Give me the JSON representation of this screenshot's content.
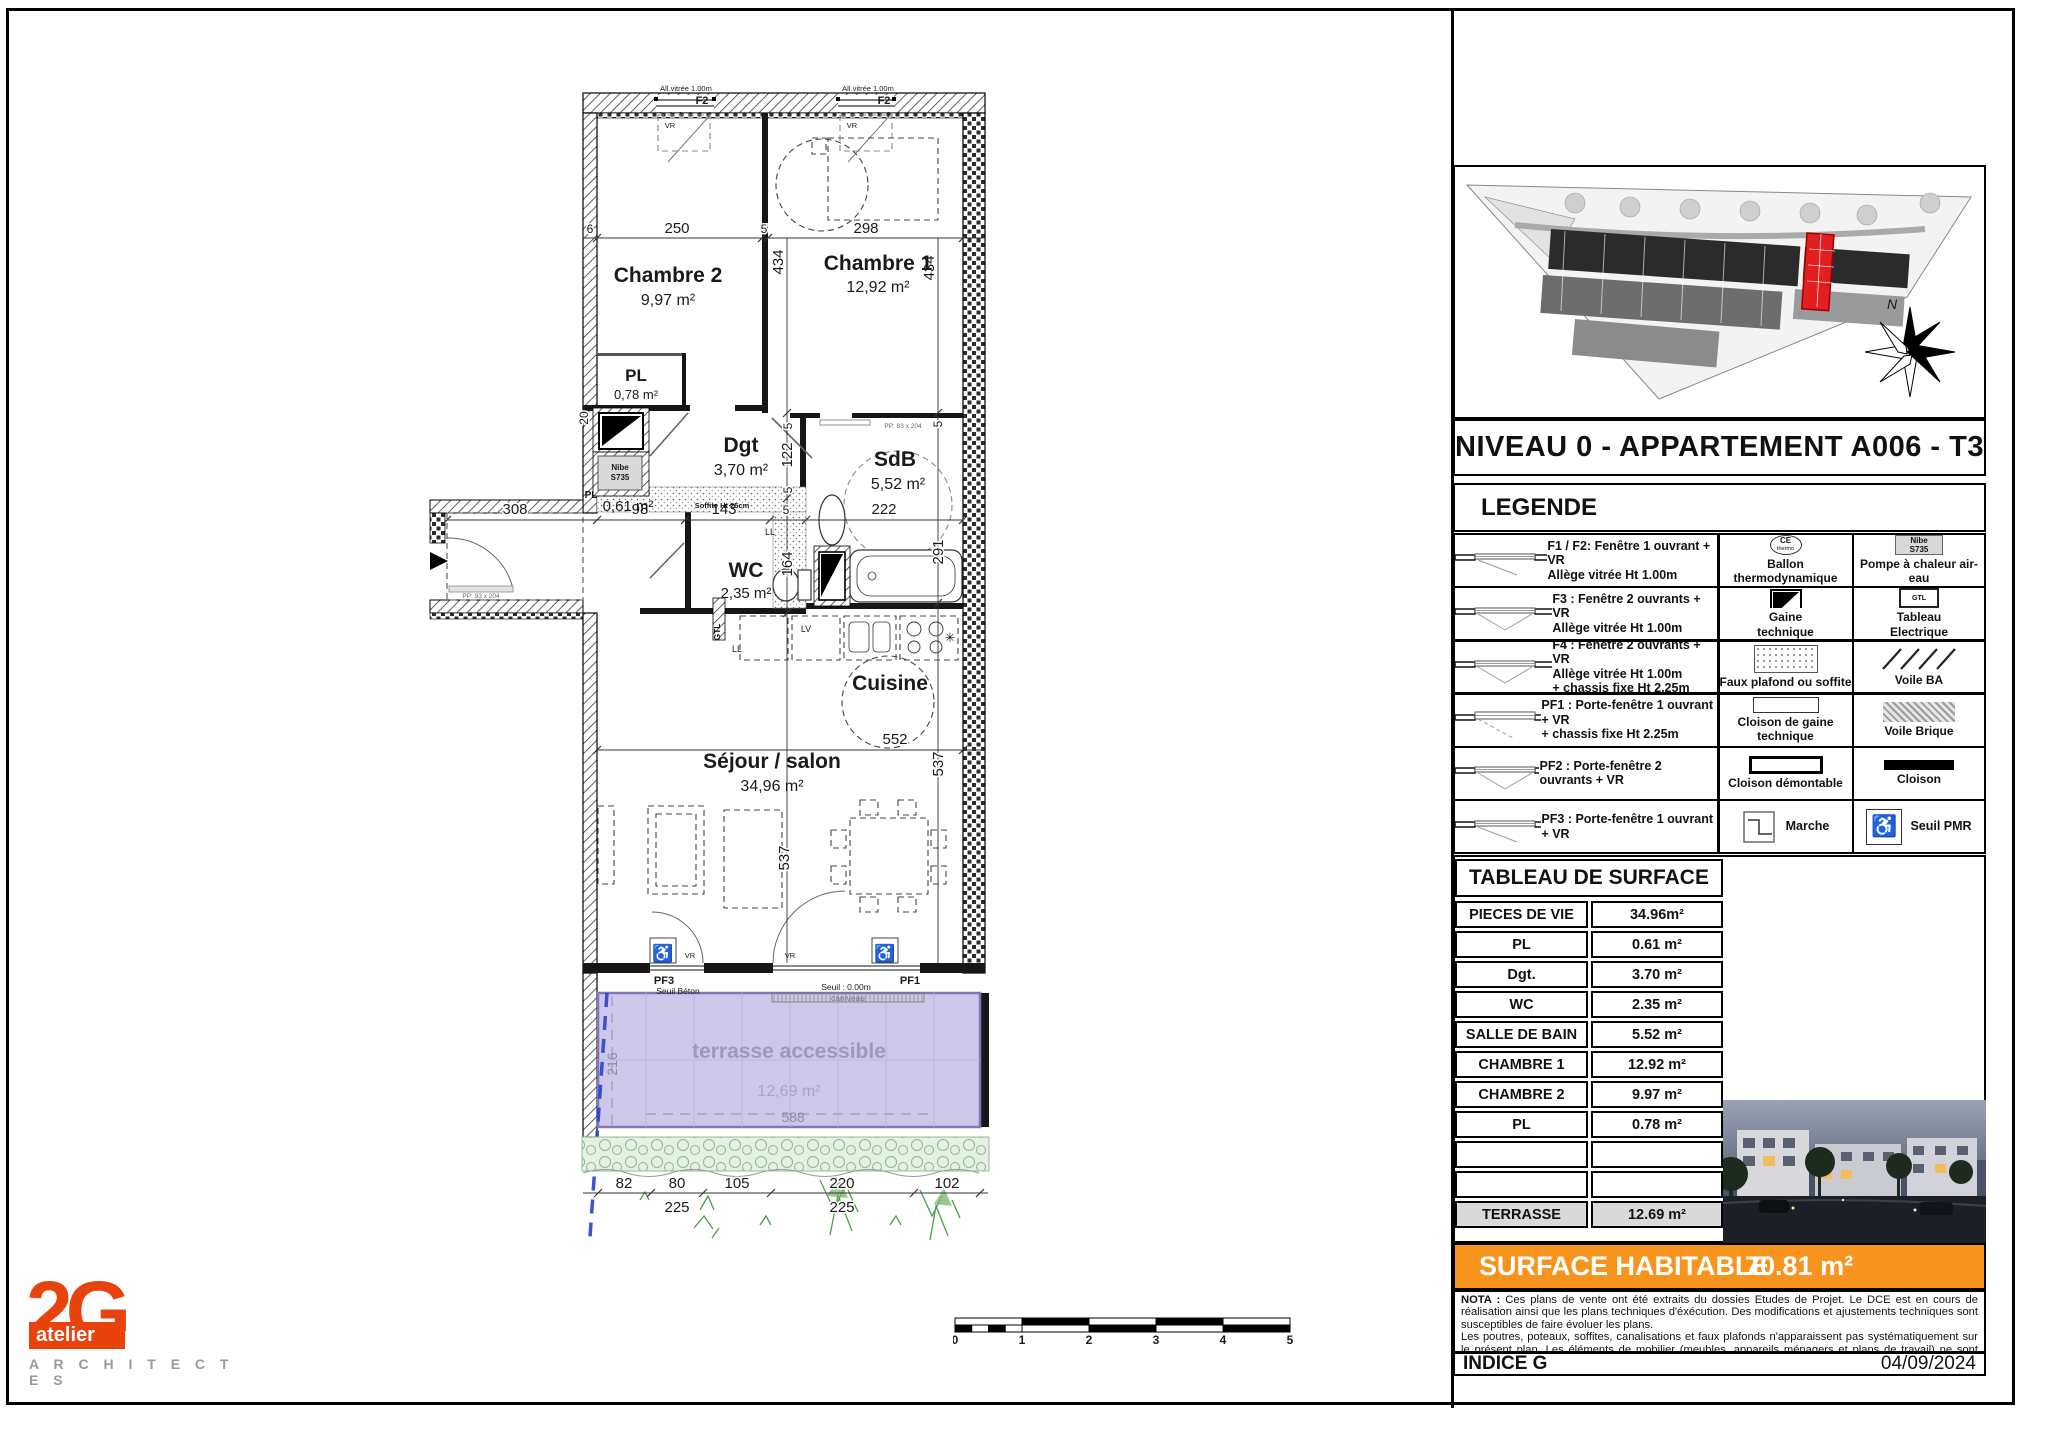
{
  "plan": {
    "rooms": {
      "chambre2": {
        "name": "Chambre 2",
        "area": "9,97 m²"
      },
      "chambre1": {
        "name": "Chambre 1",
        "area": "12,92 m²"
      },
      "pl_top": {
        "name": "PL",
        "area": "0,78 m²"
      },
      "dgt": {
        "name": "Dgt",
        "area": "3,70 m²"
      },
      "sdb": {
        "name": "SdB",
        "area": "5,52 m²"
      },
      "wc": {
        "name": "WC",
        "area": "2,35 m²"
      },
      "cuisine": {
        "name": "Cuisine"
      },
      "sejour": {
        "name": "Séjour / salon",
        "area": "34,96 m²"
      },
      "pl_small": {
        "name": "PL",
        "area": "0,61 m²"
      },
      "terrasse": {
        "name": "terrasse accessible",
        "area": "12,69 m²"
      }
    },
    "equipment": {
      "nibe1": "Nibe",
      "nibe2": "S735",
      "gtl": "GTL",
      "ll": "LL",
      "lv": "LV",
      "soffite": "Soffite Ht 25cm",
      "caniveau": "caniveau",
      "star": "✳"
    },
    "windows": {
      "allege": "All.vitrée 1.00m",
      "f2": "F2",
      "vr": "VR"
    },
    "doors": {
      "pp_entry": "PP: 93 x 204",
      "pp_sdb": "PP: 83 x 204"
    },
    "thresholds": {
      "pf3": "PF3",
      "pf1": "PF1",
      "seuil_beton": "Seuil Béton",
      "seuil_000": "Seuil : 0.00m"
    },
    "pmr_icon": "♿",
    "dims": {
      "d6": "6",
      "d250": "250",
      "d5a": "5",
      "d298": "298",
      "d434a": "434",
      "d434b": "434",
      "d20": "20",
      "d308": "308",
      "d98": "98",
      "d143": "143",
      "d5b": "5",
      "d222": "222",
      "d291": "291",
      "d122": "122",
      "d5c": "5",
      "d5d": "5",
      "d164": "164",
      "d5e": "5",
      "d552": "552",
      "d537a": "537",
      "d537b": "537",
      "d216": "216",
      "d588": "588",
      "d82": "82",
      "d80": "80",
      "d105": "105",
      "d220": "220",
      "d102": "102",
      "d225a": "225",
      "d225b": "225"
    }
  },
  "panel": {
    "title": "NIVEAU 0 - APPARTEMENT A006 - T3",
    "compass_n": "N",
    "legend": {
      "heading": "LEGENDE",
      "rows": [
        {
          "c1": "F1 / F2: Fenêtre 1 ouvrant + VR\nAllège vitrée Ht 1.00m",
          "c2": "Ballon\nthermodynamique",
          "c2_icon": "CE",
          "c2_icon_sub": "thermo",
          "c3": "Pompe à chaleur air-eau",
          "c3_icon": "Nibe\nS735"
        },
        {
          "c1": "F3 : Fenêtre 2 ouvrants + VR\nAllège vitrée Ht 1.00m",
          "c2": "Gaine\ntechnique",
          "c3": "Tableau\nElectrique",
          "c3_icon": "GTL"
        },
        {
          "c1": "F4 : Fenêtre 2 ouvrants + VR\nAllège vitrée Ht 1.00m\n+ chassis fixe Ht 2.25m",
          "c2": "Faux plafond ou soffite",
          "c3": "Voile BA"
        },
        {
          "c1": "PF1 : Porte-fenêtre 1 ouvrant + VR\n+ chassis fixe Ht 2.25m",
          "c2": "Cloison de gaine\ntechnique",
          "c3": "Voile Brique"
        },
        {
          "c1": "PF2 : Porte-fenêtre 2 ouvrants + VR",
          "c2": "Cloison démontable",
          "c3": "Cloison"
        },
        {
          "c1": "PF3 : Porte-fenêtre 1 ouvrant + VR",
          "c2": "Marche",
          "c3": "Seuil PMR",
          "c3_icon": "♿"
        }
      ]
    },
    "surface_table": {
      "heading": "TABLEAU DE SURFACE",
      "rows": [
        {
          "label": "PIECES DE VIE",
          "value": "34.96m²"
        },
        {
          "label": "PL",
          "value": "0.61 m²"
        },
        {
          "label": "Dgt.",
          "value": "3.70 m²"
        },
        {
          "label": "WC",
          "value": "2.35 m²"
        },
        {
          "label": "SALLE DE BAIN",
          "value": "5.52 m²"
        },
        {
          "label": "CHAMBRE 1",
          "value": "12.92 m²"
        },
        {
          "label": "CHAMBRE 2",
          "value": "9.97 m²"
        },
        {
          "label": "PL",
          "value": "0.78 m²"
        },
        {
          "label": "",
          "value": ""
        },
        {
          "label": "",
          "value": ""
        },
        {
          "label": "TERRASSE",
          "value": "12.69 m²"
        }
      ]
    },
    "surface_habitable": {
      "label": "SURFACE HABITABLE",
      "value": "70.81 m²"
    },
    "nota": {
      "label": "NOTA :",
      "p1": "Ces plans de vente ont été extraits du dossies Etudes de Projet. Le DCE est en cours de réalisation ainsi que les plans techniques d'éxécution. Des modifications et ajustements techniques sont susceptibles de faire évoluer les plans.",
      "p2": "Les poutres, poteaux, soffites, canalisations et faux plafonds n'apparaissent pas systématiquement sur le présent plan. Les éléments de mobilier (meubles, appareils ménagers et plans de travail) ne sont placés qu'à titre indicatif."
    },
    "indice": {
      "label": "INDICE G",
      "date": "04/09/2024"
    }
  },
  "logo": {
    "mark": "2G",
    "atelier": "atelier",
    "architectes": "A R C H I T E C T E S"
  },
  "scalebar": {
    "ticks": [
      "0",
      "1",
      "2",
      "3",
      "4",
      "5"
    ]
  },
  "colors": {
    "accent_orange": "#F7941D",
    "logo_orange": "#E8430C",
    "terrace_purple": "#CDC7EA",
    "site_red": "#E31E1E"
  }
}
